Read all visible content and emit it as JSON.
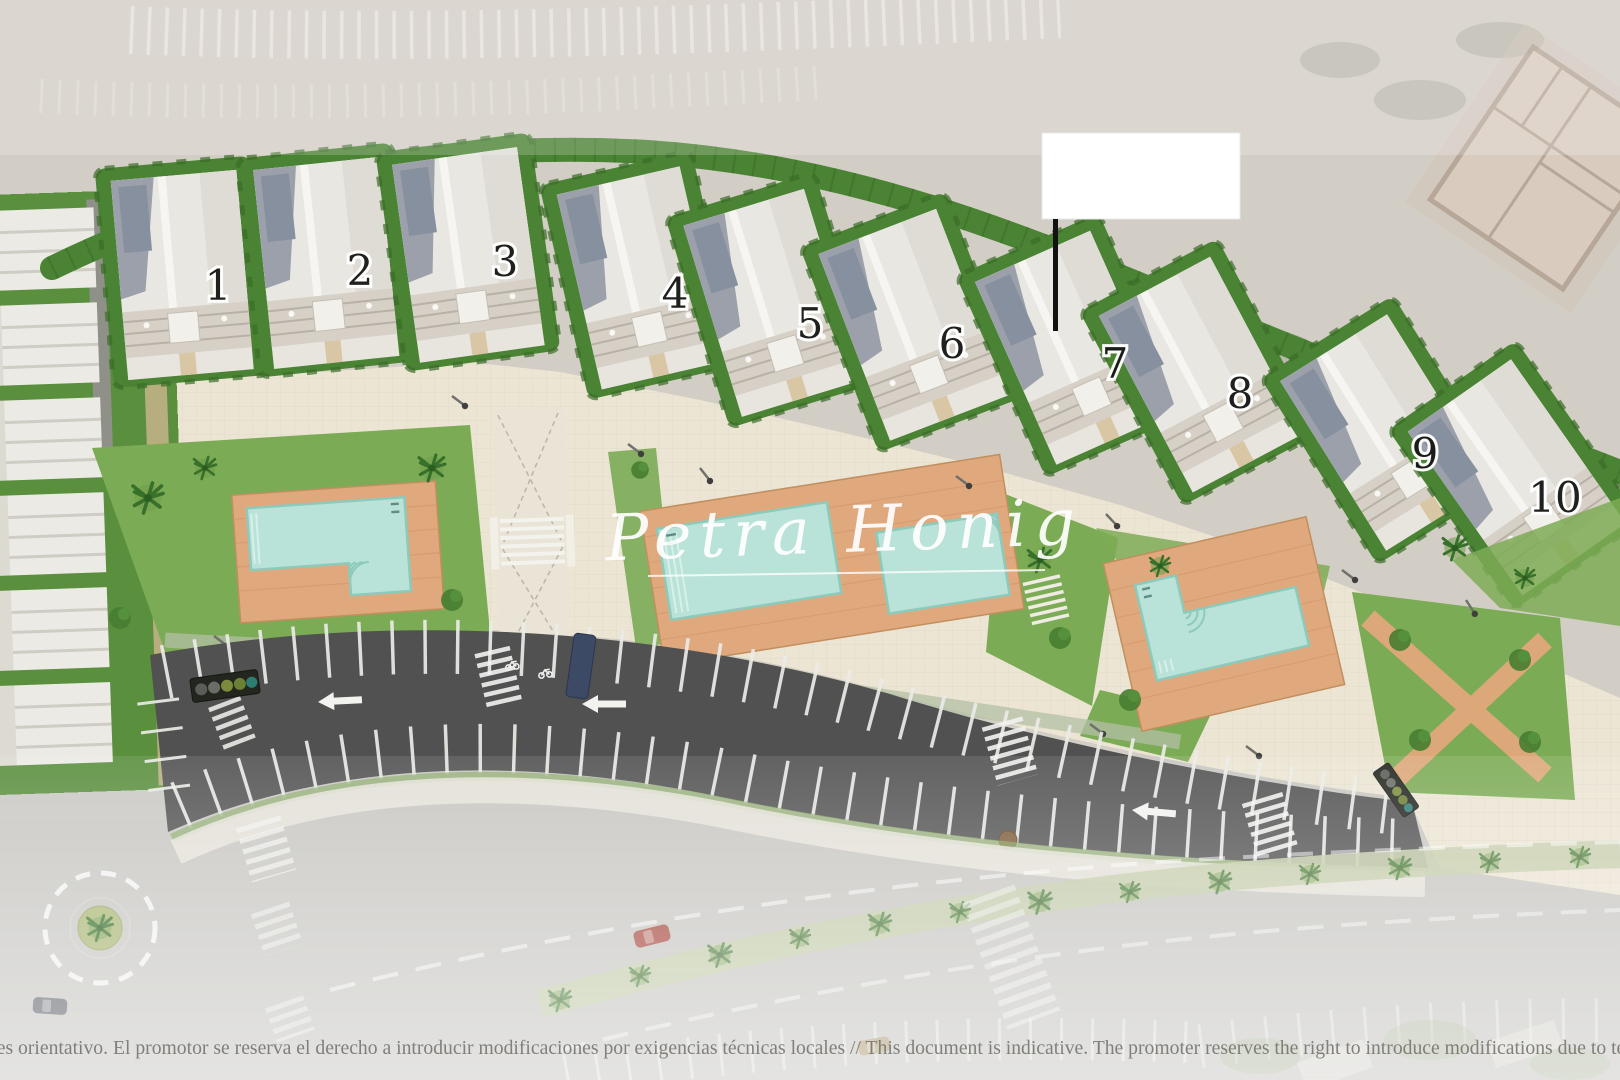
{
  "page": {
    "type": "residential development site plan",
    "view": "top-down masterplan rendering"
  },
  "watermark": {
    "text": "Petra Honig"
  },
  "plots": {
    "labels": [
      "1",
      "2",
      "3",
      "4",
      "5",
      "6",
      "7",
      "8",
      "9",
      "10"
    ]
  },
  "disclaimer": {
    "es": "o es orientativo. El promotor se reserva el derecho a introducir modificaciones por exigencias técnicas locales",
    "en": "This document is indicative. The promoter reserves the right to introduce modifications due to technical",
    "full": "o es orientativo. El promotor se reserva el derecho a introducir modificaciones por exigencias técnicas locales  //  This document is indicative. The promoter reserves the right to introduce modifications due to technical"
  },
  "features": {
    "row_house_count": 10,
    "pool_count": 4,
    "parking_lane_direction": "left",
    "roundabout": true
  },
  "colors": {
    "ground": "#d3cec5",
    "promenade": "#ece5d4",
    "hedge": "#4a8333",
    "lawn": "#7cab55",
    "pool_water": "#b9e2d8",
    "pool_deck": "#e0a87d",
    "asphalt": "#505150",
    "road": "#c7c6c2",
    "marking": "#ffffff",
    "roof": "#e9e7e2",
    "roof_shadow": "#9ba0ab",
    "plot_number": "#161616",
    "watermark": "#ffffff"
  }
}
